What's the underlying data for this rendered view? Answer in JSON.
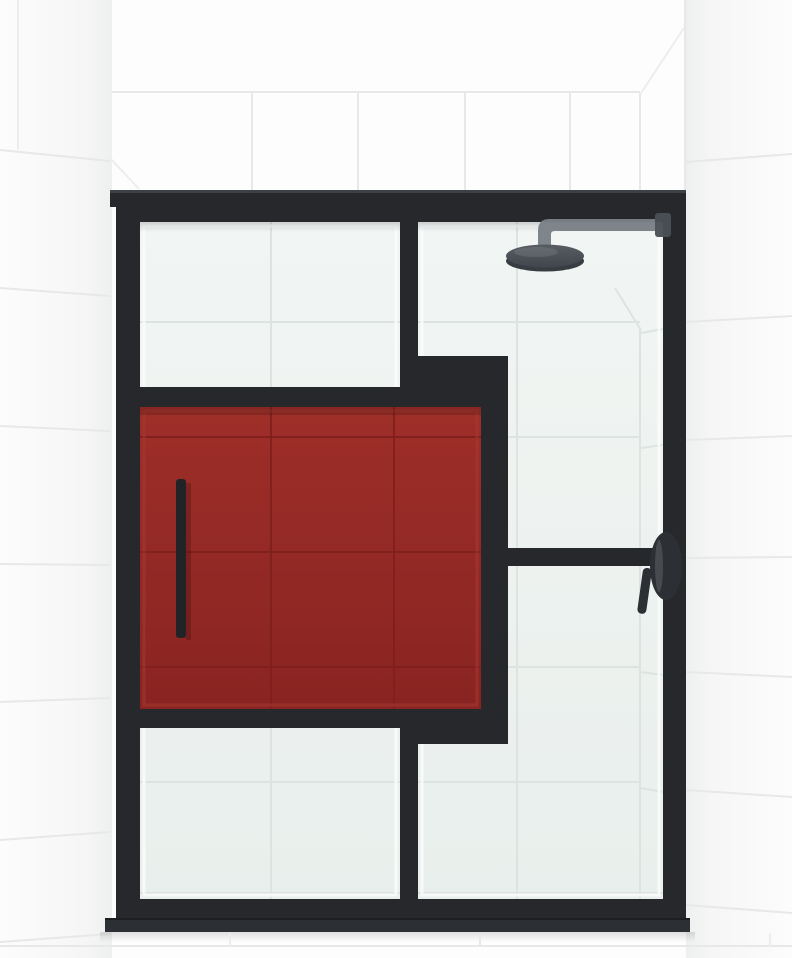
{
  "scene": {
    "kind": "product-render",
    "elements": {
      "environment": [
        "tiled-back-wall",
        "tiled-left-side-wall",
        "tiled-right-side-wall",
        "tiled-floor-strip"
      ],
      "enclosure": [
        "frame-header",
        "left-stile",
        "right-stile",
        "top-rail",
        "center-mullion",
        "transom-jog",
        "red-panel-frame",
        "right-horizontal-mullion",
        "bottom-rail",
        "bottom-sill"
      ],
      "glazing": [
        "left-upper-glass",
        "left-lower-glass",
        "right-glass-panel",
        "red-glass-panel"
      ],
      "hardware": [
        "door-pull-handle",
        "shower-arm",
        "rain-shower-head",
        "valve-lever-handle"
      ]
    }
  },
  "colors": {
    "wall_white": "#fdfdfd",
    "wall_shade": "#efefef",
    "grout": "#e7e8e8",
    "grout_soft": "#ededec",
    "frame_black": "#26282b",
    "frame_top_highlight": "#3d4044",
    "sill_gray": "#2c2f33",
    "glass_tint_top": "#f1f5f3",
    "glass_tint_bottom": "#e9efec",
    "glass_grout": "#dde3e0",
    "glass_highlight": "#fafcfb",
    "red_glass_top": "#9e2e28",
    "red_glass_bottom": "#892422",
    "red_grout": "#7f1f1c",
    "red_bevel": "#a83832",
    "handle_black": "#212327",
    "shower_metal": "#7a8187",
    "shower_metal_dark": "#4a5056",
    "shower_head_top": "#51575d",
    "shower_head_bottom": "#3a4046",
    "shower_head_rim": "#30363b",
    "valve_dark": "#2c3034"
  }
}
